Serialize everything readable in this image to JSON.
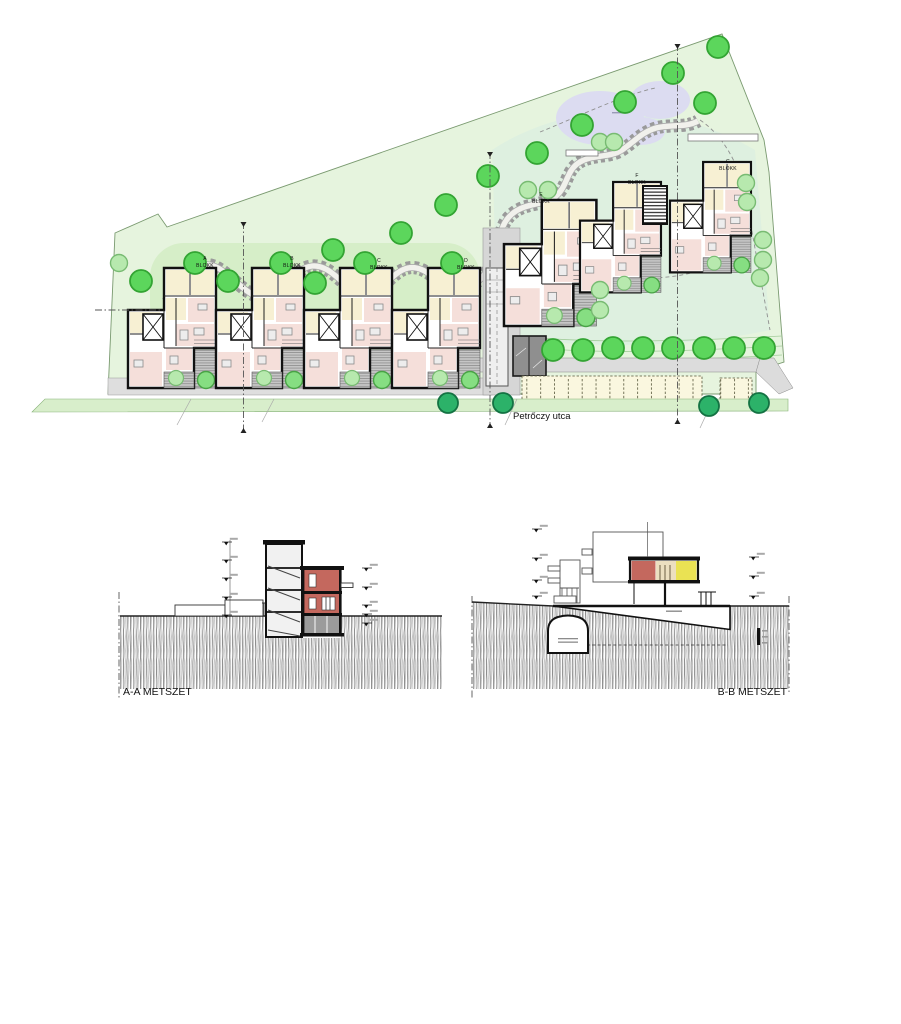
{
  "site_plan": {
    "street_label": "Petrőczy utca",
    "blocks": [
      {
        "letter": "A",
        "word": "BLOKK"
      },
      {
        "letter": "B",
        "word": "BLOKK"
      },
      {
        "letter": "C",
        "word": "BLOKK"
      },
      {
        "letter": "D",
        "word": "BLOKK"
      },
      {
        "letter": "E",
        "word": "BLOKK"
      },
      {
        "letter": "F",
        "word": "BLOKK"
      },
      {
        "letter": "G",
        "word": "BLOKK"
      }
    ],
    "parking": {
      "group1_stalls": 13,
      "group2_stalls": 3
    }
  },
  "sections": {
    "aa_label": "A-A METSZET",
    "bb_label": "B-B METSZET"
  }
}
